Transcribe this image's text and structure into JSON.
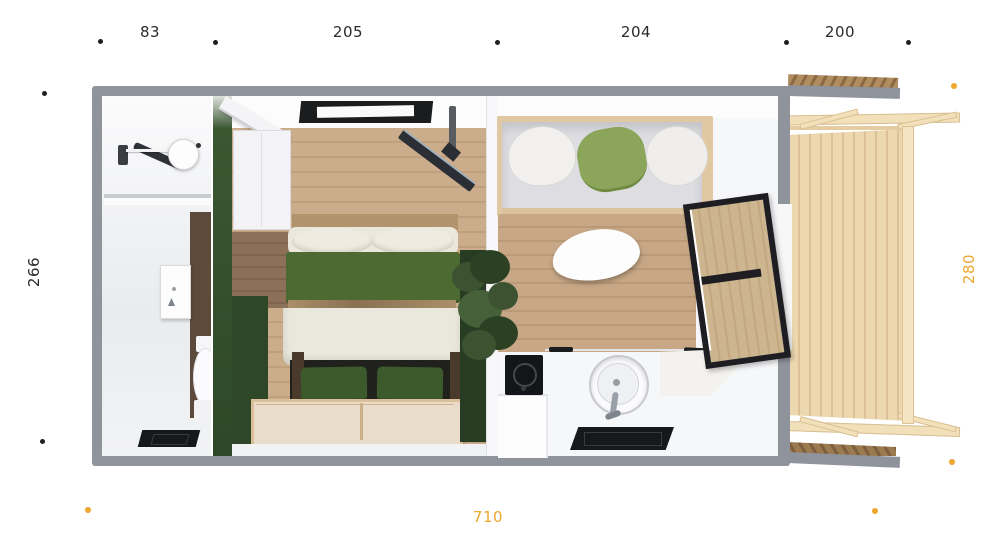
{
  "dimensions": {
    "top": [
      "83",
      "205",
      "204",
      "200"
    ],
    "left": "266",
    "right": "280",
    "bottom": "710"
  },
  "colors": {
    "dim_text": "#2b2b2b",
    "marker_black": "#1f1f1f",
    "accent_orange": "#eda62e",
    "wall_gray": "#8f939c",
    "green_dark": "#2e4827",
    "green_blanket": "#4d6a33",
    "green_pillow": "#8ba65a",
    "wood_floor": "#c9aa89",
    "wood_deck": "#ecd7af",
    "wood_brown_wall": "#5d4a3b",
    "appliance_black": "#17181b"
  }
}
